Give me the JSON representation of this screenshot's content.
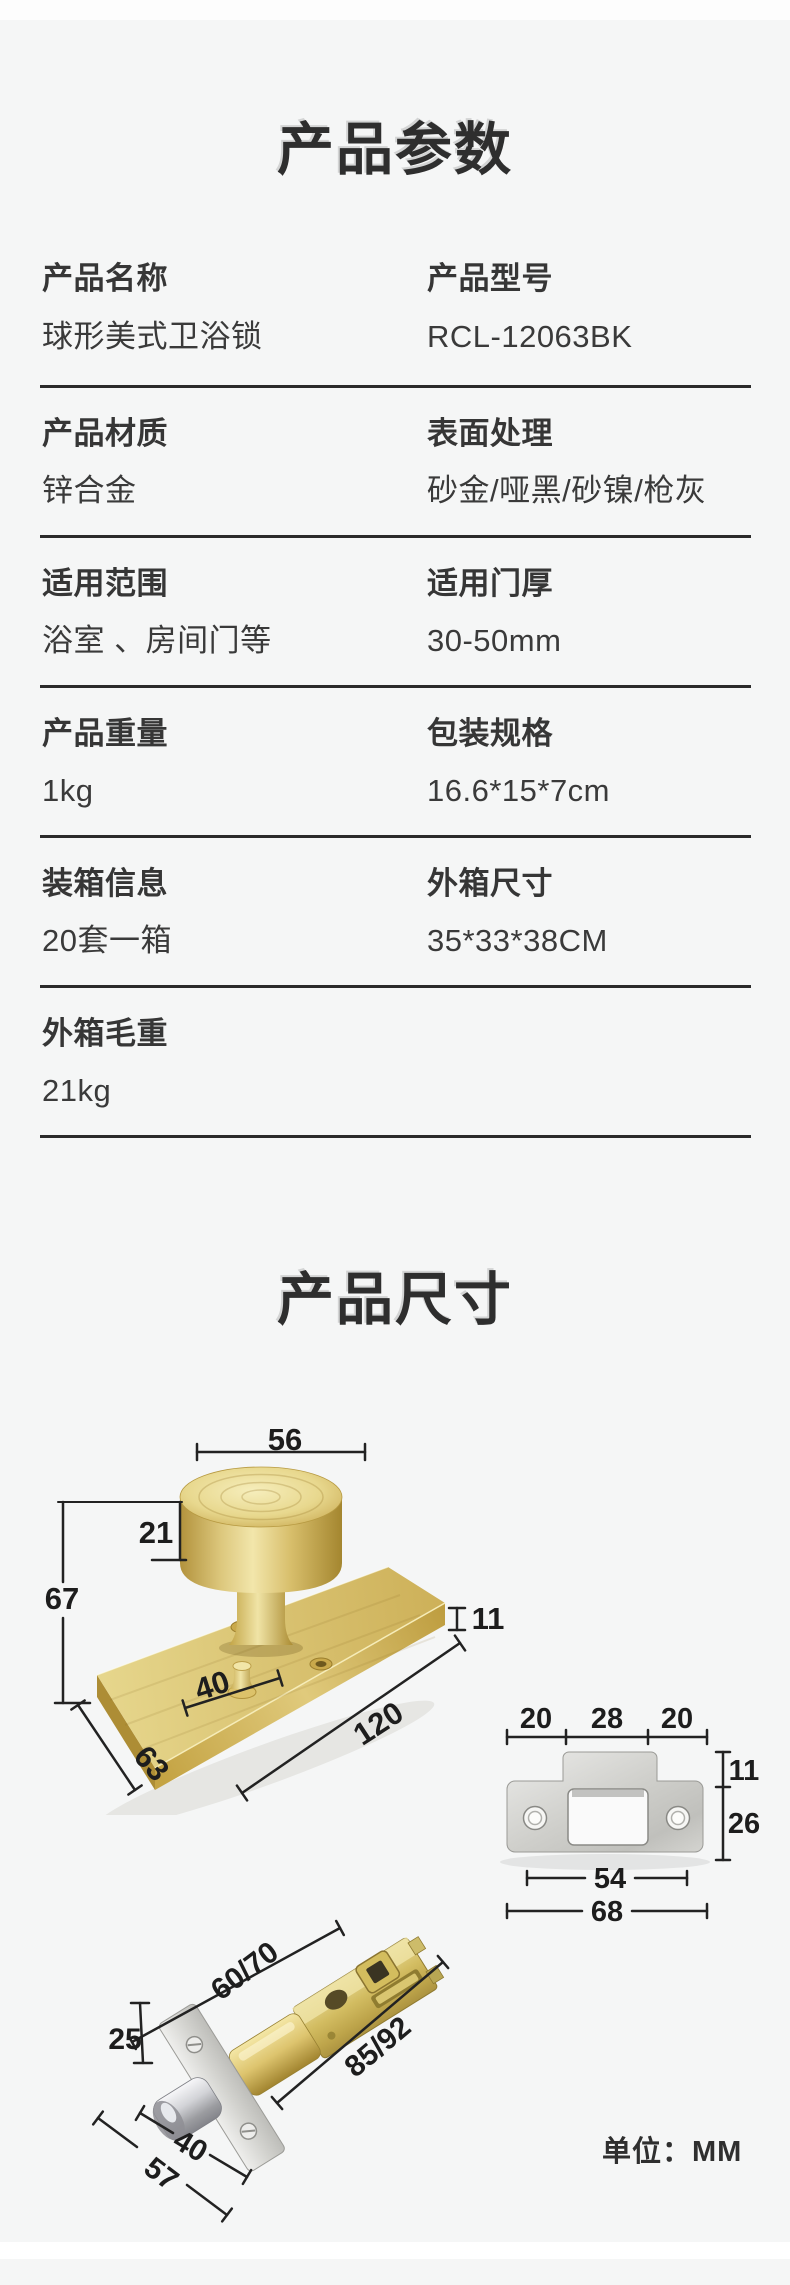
{
  "params": {
    "title": "产品参数",
    "rows": [
      {
        "left_label": "产品名称",
        "left_value": "球形美式卫浴锁",
        "right_label": "产品型号",
        "right_value": "RCL-12063BK"
      },
      {
        "left_label": "产品材质",
        "left_value": "锌合金",
        "right_label": "表面处理",
        "right_value": "砂金/哑黑/砂镍/枪灰"
      },
      {
        "left_label": "适用范围",
        "left_value": "浴室 、房间门等",
        "right_label": "适用门厚",
        "right_value": "30-50mm"
      },
      {
        "left_label": "产品重量",
        "left_value": "1kg",
        "right_label": "包装规格",
        "right_value": "16.6*15*7cm"
      },
      {
        "left_label": "装箱信息",
        "left_value": "20套一箱",
        "right_label": "外箱尺寸",
        "right_value": "35*33*38CM"
      },
      {
        "left_label": "外箱毛重",
        "left_value": "21kg",
        "right_label": "",
        "right_value": ""
      }
    ]
  },
  "dims": {
    "title": "产品尺寸",
    "unit_note": "单位：MM",
    "knob": {
      "top_width": "56",
      "head_height": "21",
      "total_height": "67",
      "screw_span": "40",
      "plate_thickness": "11",
      "plate_length": "120",
      "plate_depth": "63"
    },
    "strike": {
      "seg_left": "20",
      "seg_mid": "28",
      "seg_right": "20",
      "tab_height": "11",
      "body_height": "26",
      "inner_width": "54",
      "outer_width": "68"
    },
    "latch": {
      "backset": "60/70",
      "overall": "85/92",
      "plate_width": "25",
      "adjust_span": "40",
      "plate_height": "57"
    }
  },
  "colors": {
    "background": "#f5f6f6",
    "divider": "#2b2b2b",
    "text": "#333333",
    "brass": "#d9c06a",
    "steel": "#cfcfcb",
    "chrome": "#9b9ca0"
  }
}
